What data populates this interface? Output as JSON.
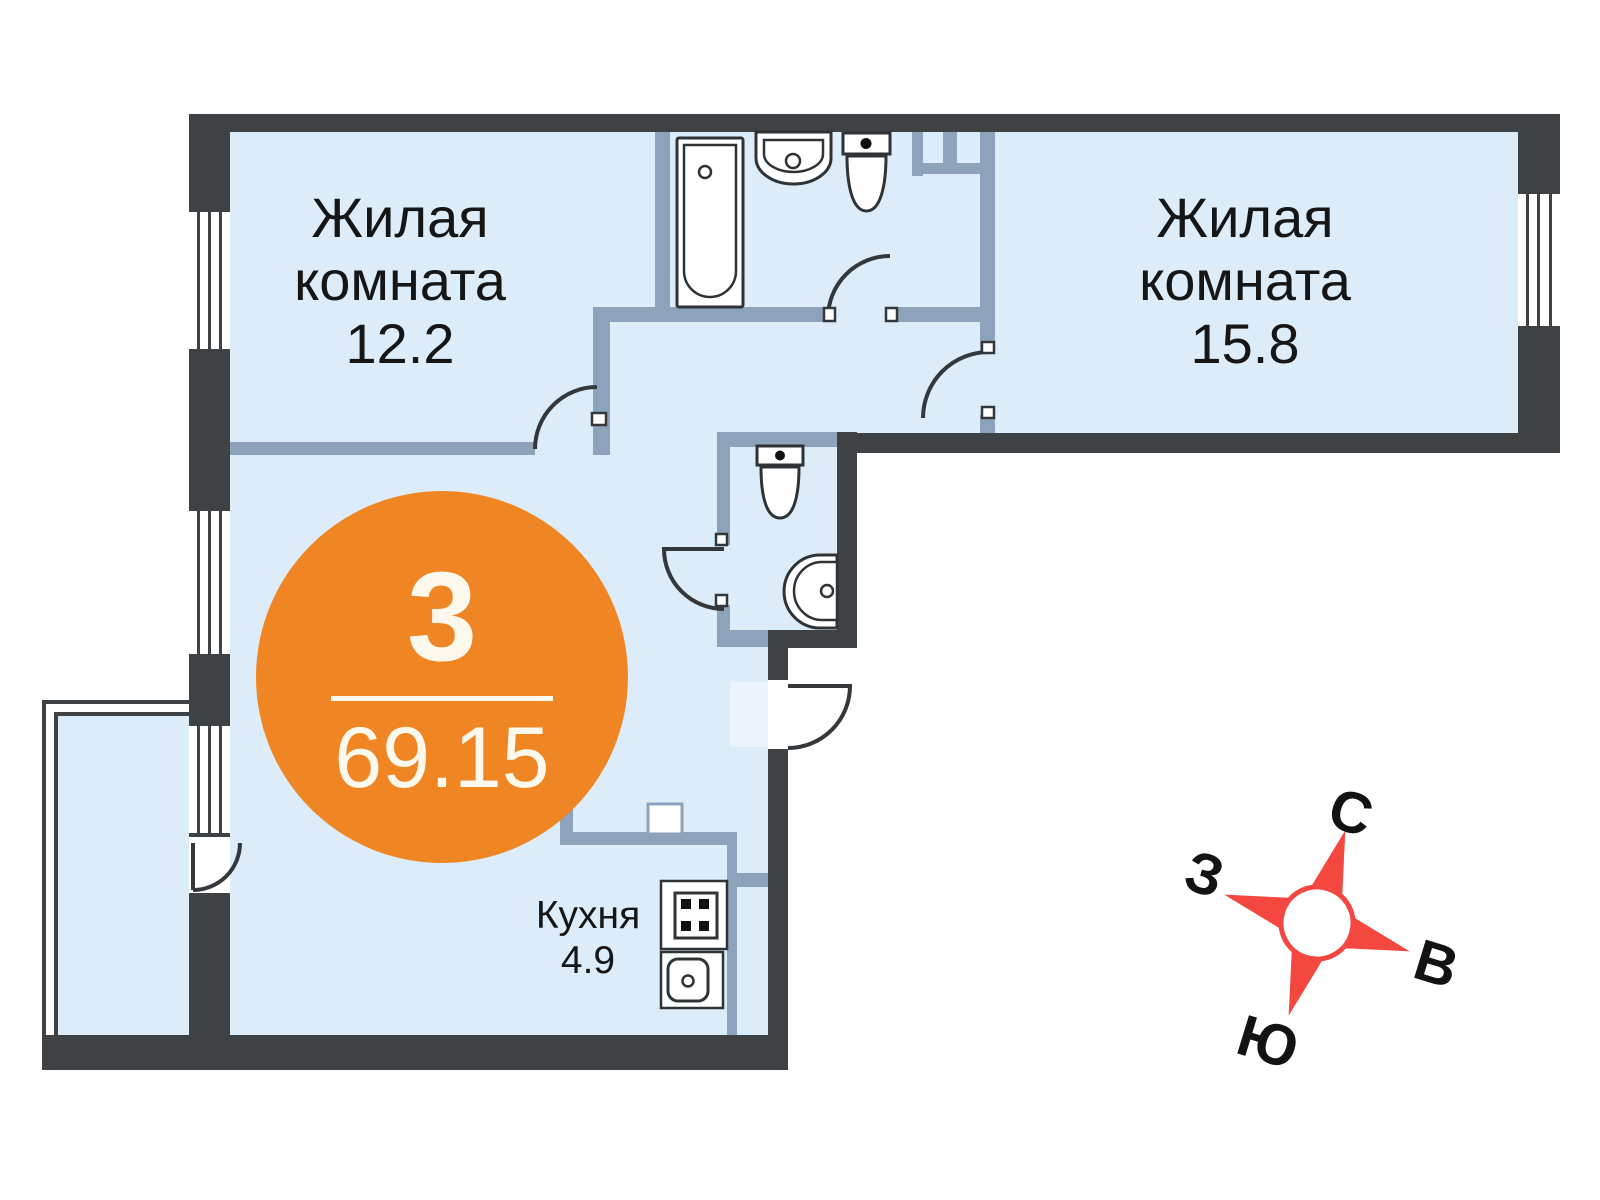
{
  "rooms": [
    {
      "name": "Жилая комната",
      "area": "12.2"
    },
    {
      "name": "Жилая комната",
      "area": "15.8"
    },
    {
      "name": "Кухня",
      "area": "4.9"
    }
  ],
  "badge": {
    "room_count": "3",
    "total_area": "69.15"
  },
  "compass": {
    "north": "С",
    "east": "В",
    "south": "Ю",
    "west": "З"
  },
  "colors": {
    "floor": "#dcecf8",
    "wall_interior": "#8da2bb",
    "wall_exterior": "#3f4245",
    "accent_orange": "#ef8623",
    "compass_red": "#f4473f"
  }
}
